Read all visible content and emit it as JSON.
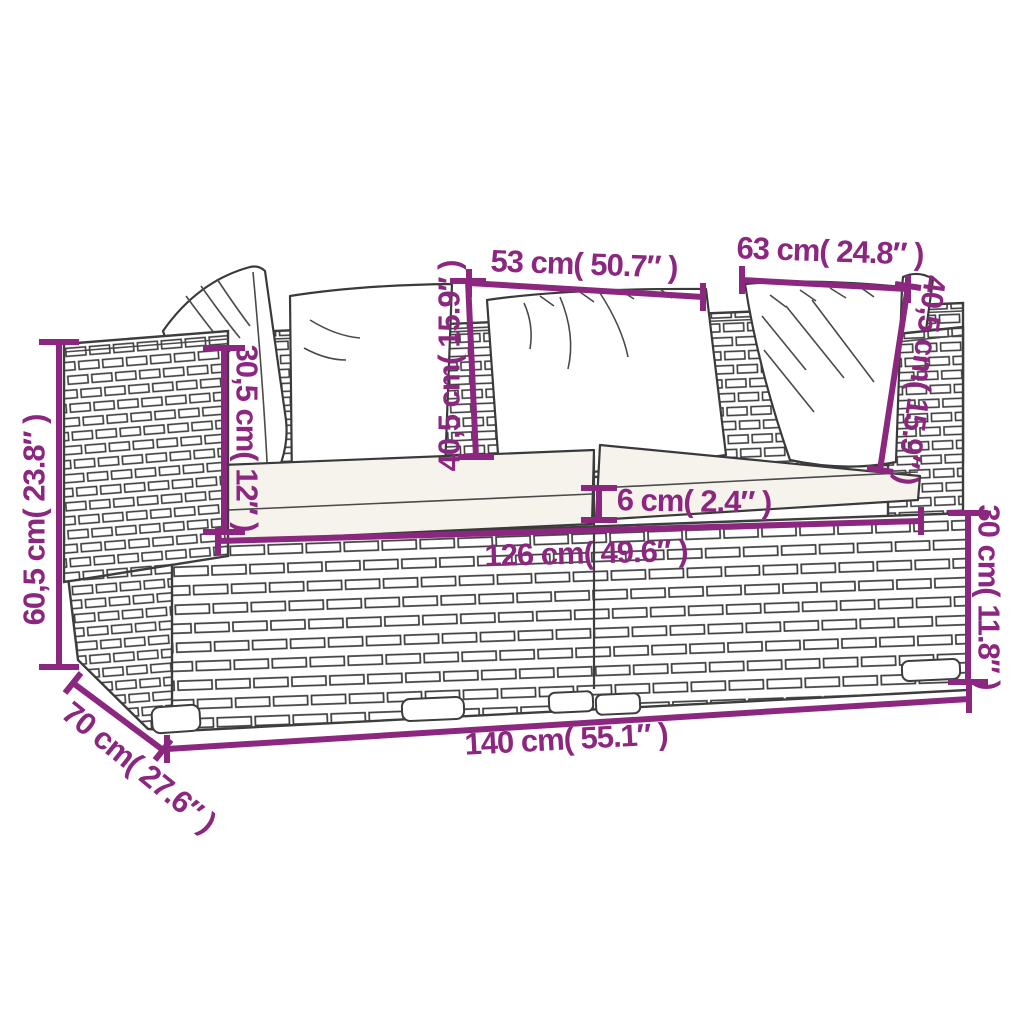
{
  "diagram": {
    "type": "product-dimension-diagram",
    "subject": "2-piece poly rattan garden lounge sofa with cushions",
    "background_color": "#ffffff",
    "accent_color": "#8C2780",
    "ink_color": "#333333",
    "dimensions": [
      {
        "id": "back-pillow-center-width",
        "label": "53 cm( 50.7″ )"
      },
      {
        "id": "back-pillow-right-width",
        "label": "63 cm( 24.8″ )"
      },
      {
        "id": "overall-height",
        "label": "60,5 cm( 23.8″ )"
      },
      {
        "id": "armrest-above-seat-height",
        "label": "30,5 cm( 12″ )"
      },
      {
        "id": "back-pillow-height-center",
        "label": "40,5 cm( 15.9″ )"
      },
      {
        "id": "back-pillow-height-right",
        "label": "40,5 cm( 15.9″ )"
      },
      {
        "id": "seat-cushion-thickness",
        "label": "6 cm( 2.4″ )"
      },
      {
        "id": "seat-width",
        "label": "126 cm( 49.6″ )"
      },
      {
        "id": "base-height",
        "label": "30 cm( 11.8″ )"
      },
      {
        "id": "overall-width",
        "label": "140 cm( 55.1″ )"
      },
      {
        "id": "overall-depth",
        "label": "70 cm( 27.6″ )"
      }
    ]
  }
}
